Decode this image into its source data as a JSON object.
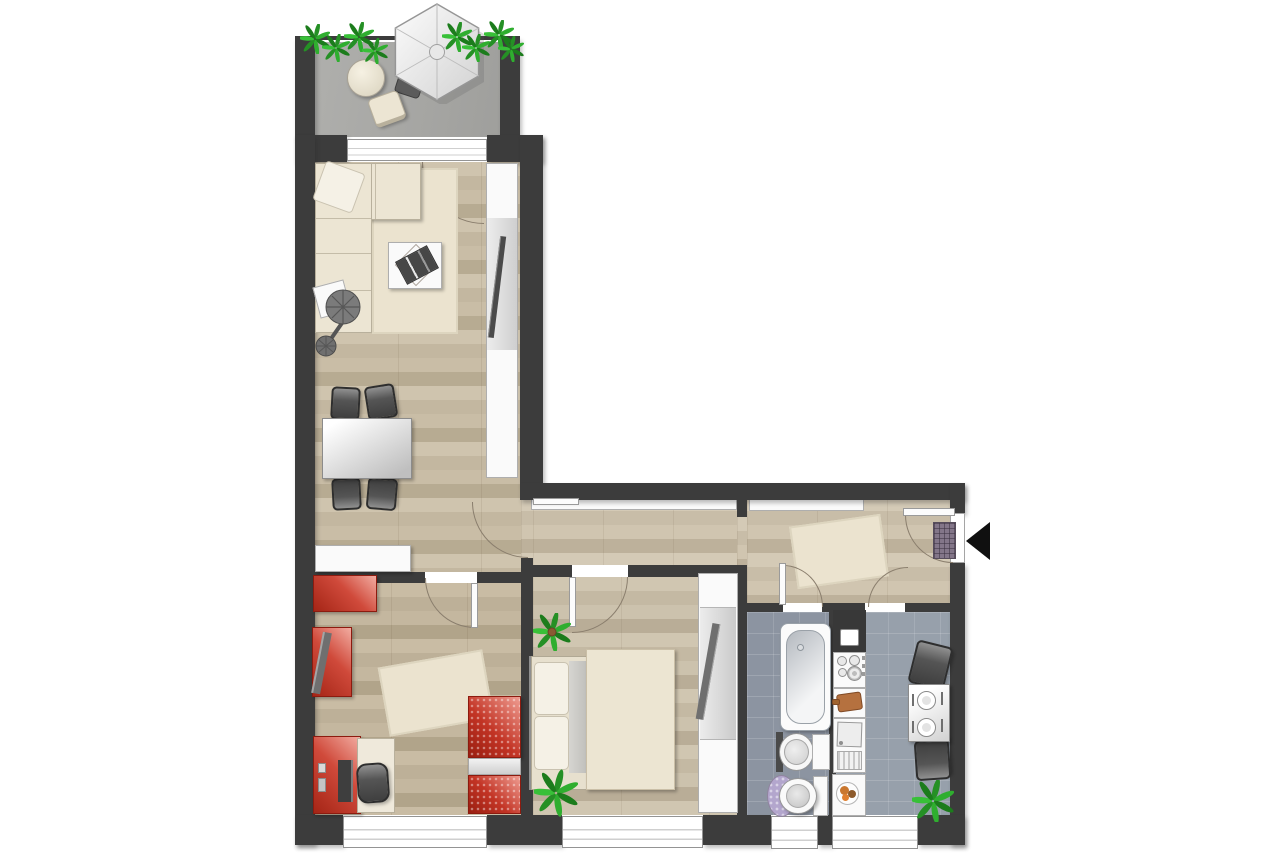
{
  "document": {
    "kind": "apartment-floor-plan",
    "visible_text": [],
    "entrance": {
      "marker": "black-arrow",
      "direction": "left",
      "location": "right-exterior-wall"
    }
  },
  "palette": {
    "background": "#ffffff",
    "wall": "#3c3c3c",
    "wood_floor": "#c6baa3",
    "hall_wood_floor": "#cec3ae",
    "bathroom_tile": "#8c94a1",
    "kitchen_tile": "#97a0ab",
    "balcony_concrete": "#a9a9a6",
    "accent_red_furniture": "#c23325",
    "cream_furniture": "#ece5d3",
    "plant_green": "#2c9c2c",
    "bath_mat_lavender": "#b3a6cd",
    "cutting_board_brown": "#b5713f"
  },
  "rooms": [
    {
      "name": "balcony",
      "floor": "concrete",
      "items": [
        "parasol",
        "round-table",
        "balcony-chair",
        "lounge-seat",
        "planter-plants"
      ]
    },
    {
      "name": "living-dining-room",
      "floor": "wood",
      "items": [
        "corner-sofa",
        "throw-pillow",
        "area-rug",
        "coffee-table",
        "decor-tray",
        "side-table",
        "floor-lamp",
        "tv-sideboard",
        "tv",
        "dining-table",
        "dining-chairs-x4",
        "sideboard",
        "balcony-window-door"
      ]
    },
    {
      "name": "childrens-room",
      "floor": "wood",
      "items": [
        "red-dresser",
        "red-wall-shelf",
        "leaning-board",
        "area-rug",
        "red-desk",
        "desk-pad",
        "monitor",
        "office-chair",
        "red-bed",
        "window"
      ]
    },
    {
      "name": "bedroom",
      "floor": "wood",
      "items": [
        "double-bed",
        "pillows-x2",
        "duvet",
        "potted-plant-x2",
        "wardrobe",
        "mirror",
        "window"
      ]
    },
    {
      "name": "hallway",
      "floor": "wood",
      "items": [
        "built-in-closet-west",
        "built-in-closet-east",
        "area-rug",
        "doormat",
        "entrance-door"
      ]
    },
    {
      "name": "bathroom",
      "floor": "tile",
      "items": [
        "bathtub",
        "washbasin",
        "bath-cabinet",
        "toilet",
        "bath-mat",
        "window"
      ]
    },
    {
      "name": "kitchen",
      "floor": "tile",
      "items": [
        "tall-unit",
        "stove-4-burners",
        "cutting-board",
        "sink-with-drainer",
        "base-cabinet",
        "fruit-bowl",
        "small-table",
        "place-settings-x2",
        "chairs-x2",
        "potted-plant",
        "window"
      ]
    }
  ],
  "doors": [
    "balcony-to-living",
    "living-to-hallway",
    "hallway-to-childrens-room",
    "hallway-to-bedroom",
    "hallway-to-bathroom",
    "hallway-to-kitchen",
    "apartment-entrance"
  ]
}
